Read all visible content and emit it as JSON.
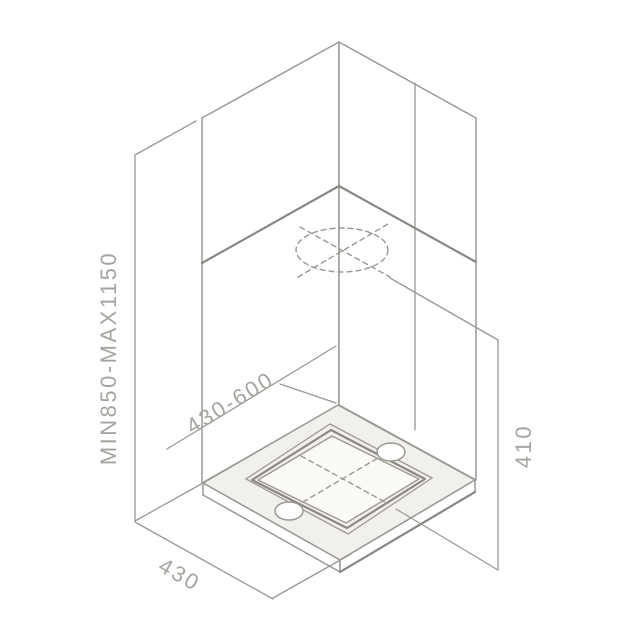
{
  "diagram": {
    "type": "technical-installation-drawing",
    "subject": "island-cooker-hood-dimensions",
    "dimensions": [
      {
        "id": "height-range",
        "label": "MIN850-MAX1150",
        "orientation": "vertical-left"
      },
      {
        "id": "top-edge-range",
        "label": "430-600",
        "orientation": "isometric-upper-left"
      },
      {
        "id": "body-height",
        "label": "410",
        "orientation": "vertical-right"
      },
      {
        "id": "depth",
        "label": "430",
        "orientation": "isometric-lower-left"
      }
    ]
  },
  "colors": {
    "line": "#9b9893",
    "line_dark": "#8b8883",
    "fill_light": "#f2f0ec",
    "panel": "#fbfaf7",
    "text": "#a7a49e",
    "background": "#ffffff"
  }
}
